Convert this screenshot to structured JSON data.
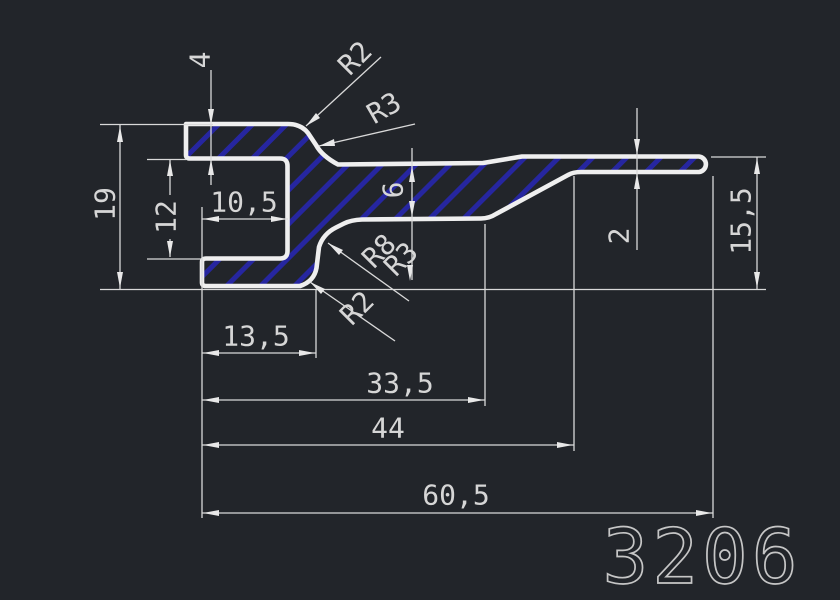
{
  "drawing": {
    "part_number": "3206",
    "type": "profile-cross-section",
    "colors": {
      "background": "#22252a",
      "outline": "#efefef",
      "hatch_blue": "#2626a0",
      "dimension_gray": "#d6d6d6"
    },
    "dimensions": {
      "top_flange_thickness": "4",
      "overall_height": "19",
      "slot_height": "12",
      "slot_depth": "10,5",
      "web_thickness": "6",
      "tail_thickness": "2",
      "right_end_height": "15,5",
      "length_to_step": "13,5",
      "length_to_taper": "33,5",
      "length_to_tail": "44",
      "overall_length": "60,5"
    },
    "radii": {
      "top_fillet_r2": "R2",
      "top_fillet_r3": "R3",
      "mid_fillet_r8": "R8",
      "mid_fillet_r3": "R3",
      "bottom_fillet_r2": "R2"
    }
  }
}
